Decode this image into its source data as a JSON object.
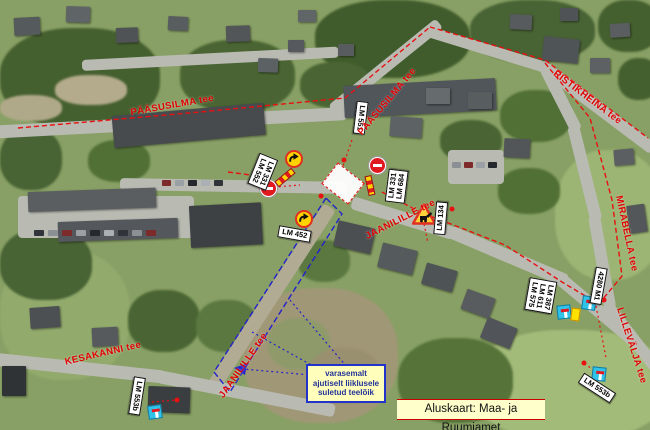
{
  "colors": {
    "street_label": "#e00000",
    "route_line": "#e81010",
    "closure_line": "#2222cc",
    "sign_label_bg": "#ffffff",
    "detour_sign": "#ffd400",
    "no_entry_sign": "#e01820",
    "dead_end_sign": "#2fc3ea",
    "note_bg": "#ffffbb",
    "note_border": "#2233cc",
    "banner_bg": "#ffffcc"
  },
  "streets": {
    "paasusilma_west": "PÄÄSUSILMA tee",
    "paasusilma_east": "PÄÄSUSILMA tee",
    "ristikheina": "RISTIKHEINA tee",
    "mirabella": "MIRABELLA tee",
    "jaanilille_east": "JAANILILLE tee",
    "jaanilille_south": "JAANILILLE tee",
    "kesakanni": "KESAKANNI tee",
    "lillevalja": "LILLEVÄLJA tee"
  },
  "sign_labels": {
    "lm551": "LM 551",
    "west_pair_1": "LM 331",
    "west_pair_2": "LM 552",
    "east_pair_1": "LM 331",
    "east_pair_2": "LM 684",
    "lm452": "LM 452",
    "lm134": "LM 134",
    "stack_1": "LM 387",
    "stack_2": "LM 611",
    "stack_3": "LM 575",
    "m4280": "4280 M1",
    "lm553b_left": "LM 553b",
    "lm553b_right": "LM 553b"
  },
  "icons": {
    "no_entry": "no-entry-sign",
    "detour": "detour-arrow-sign",
    "roadworks": "roadworks-sign",
    "dead_end": "dead-end-sign",
    "barrier": "barrier-board"
  },
  "note_box": {
    "line1": "varasemalt",
    "line2": "ajutiselt liiklusele",
    "line3": "suletud teelõik"
  },
  "banner": {
    "text": "Aluskaart: Maa- ja Ruumiamet"
  }
}
